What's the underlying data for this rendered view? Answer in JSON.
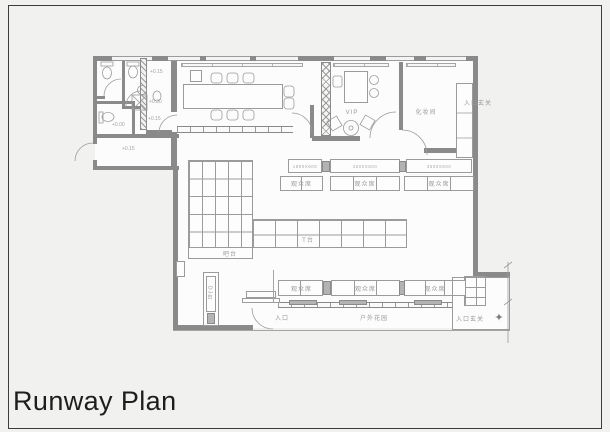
{
  "title": "Runway Plan",
  "labels": {
    "vip": "VIP",
    "makeup_room": "化妆间",
    "entrance_foyer": "入口玄关",
    "audience_seat": "观众席",
    "runway": "T台",
    "bar": "吧台",
    "dj_booth": "DJ台",
    "entrance": "入口",
    "outdoor_garden": "户外花园"
  },
  "dimensions": {
    "bench_small": "1800X600",
    "bench_large": "3600X600"
  },
  "elevations": {
    "e015": "+0.15",
    "e030": "+0.30",
    "e000": "+0.00"
  },
  "icons": {
    "north_arrow": "✦"
  },
  "colors": {
    "wall": "#8a8a8a",
    "line": "#9b9b9b",
    "label_text": "#9a9a9a",
    "title_text": "#1e1e1d",
    "background": "#f1f1f0",
    "room_fill": "#fcfcfc"
  }
}
